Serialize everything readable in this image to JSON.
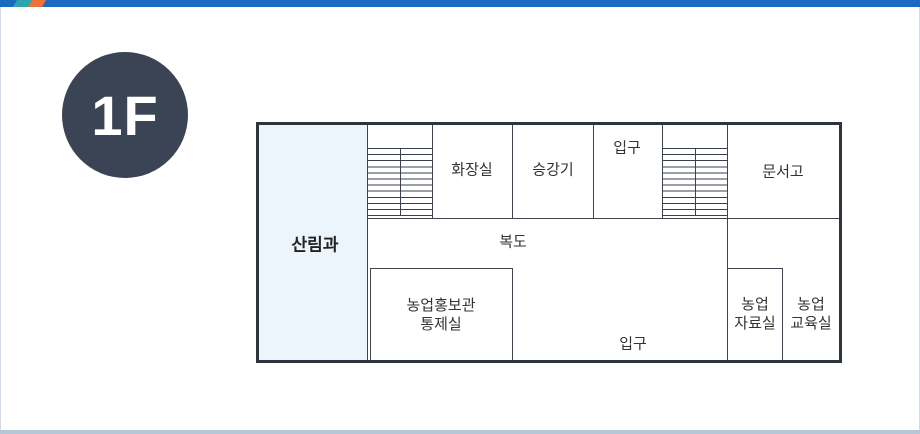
{
  "floor_badge": {
    "label": "1F"
  },
  "colors": {
    "top_bar_blue": "#1a6ac2",
    "top_bar_teal": "#2aa6ac",
    "top_bar_orange": "#f2703a",
    "bottom_bar": "#b7c5d9",
    "badge_background": "#3a4454",
    "badge_text": "#ffffff",
    "highlight_room_fill": "#ecf4fc",
    "wall": "#2e343c",
    "interior_line": "#3f444c",
    "stair_line": "#39404e",
    "label_text": "#333333"
  },
  "floor_plan": {
    "rooms": {
      "forestry": {
        "label": "산림과"
      },
      "restroom": {
        "label": "화장실"
      },
      "elevator": {
        "label": "승강기"
      },
      "entrance_top": {
        "label": "입구"
      },
      "archive": {
        "label": "문서고"
      },
      "corridor": {
        "label": "복도"
      },
      "pr_control": {
        "line1": "농업홍보관",
        "line2": "통제실"
      },
      "entrance_bottom": {
        "label": "입구"
      },
      "ag_data": {
        "line1": "농업",
        "line2": "자료실"
      },
      "ag_edu": {
        "line1": "농업",
        "line2": "교육실"
      }
    },
    "stairs_count": 2
  }
}
